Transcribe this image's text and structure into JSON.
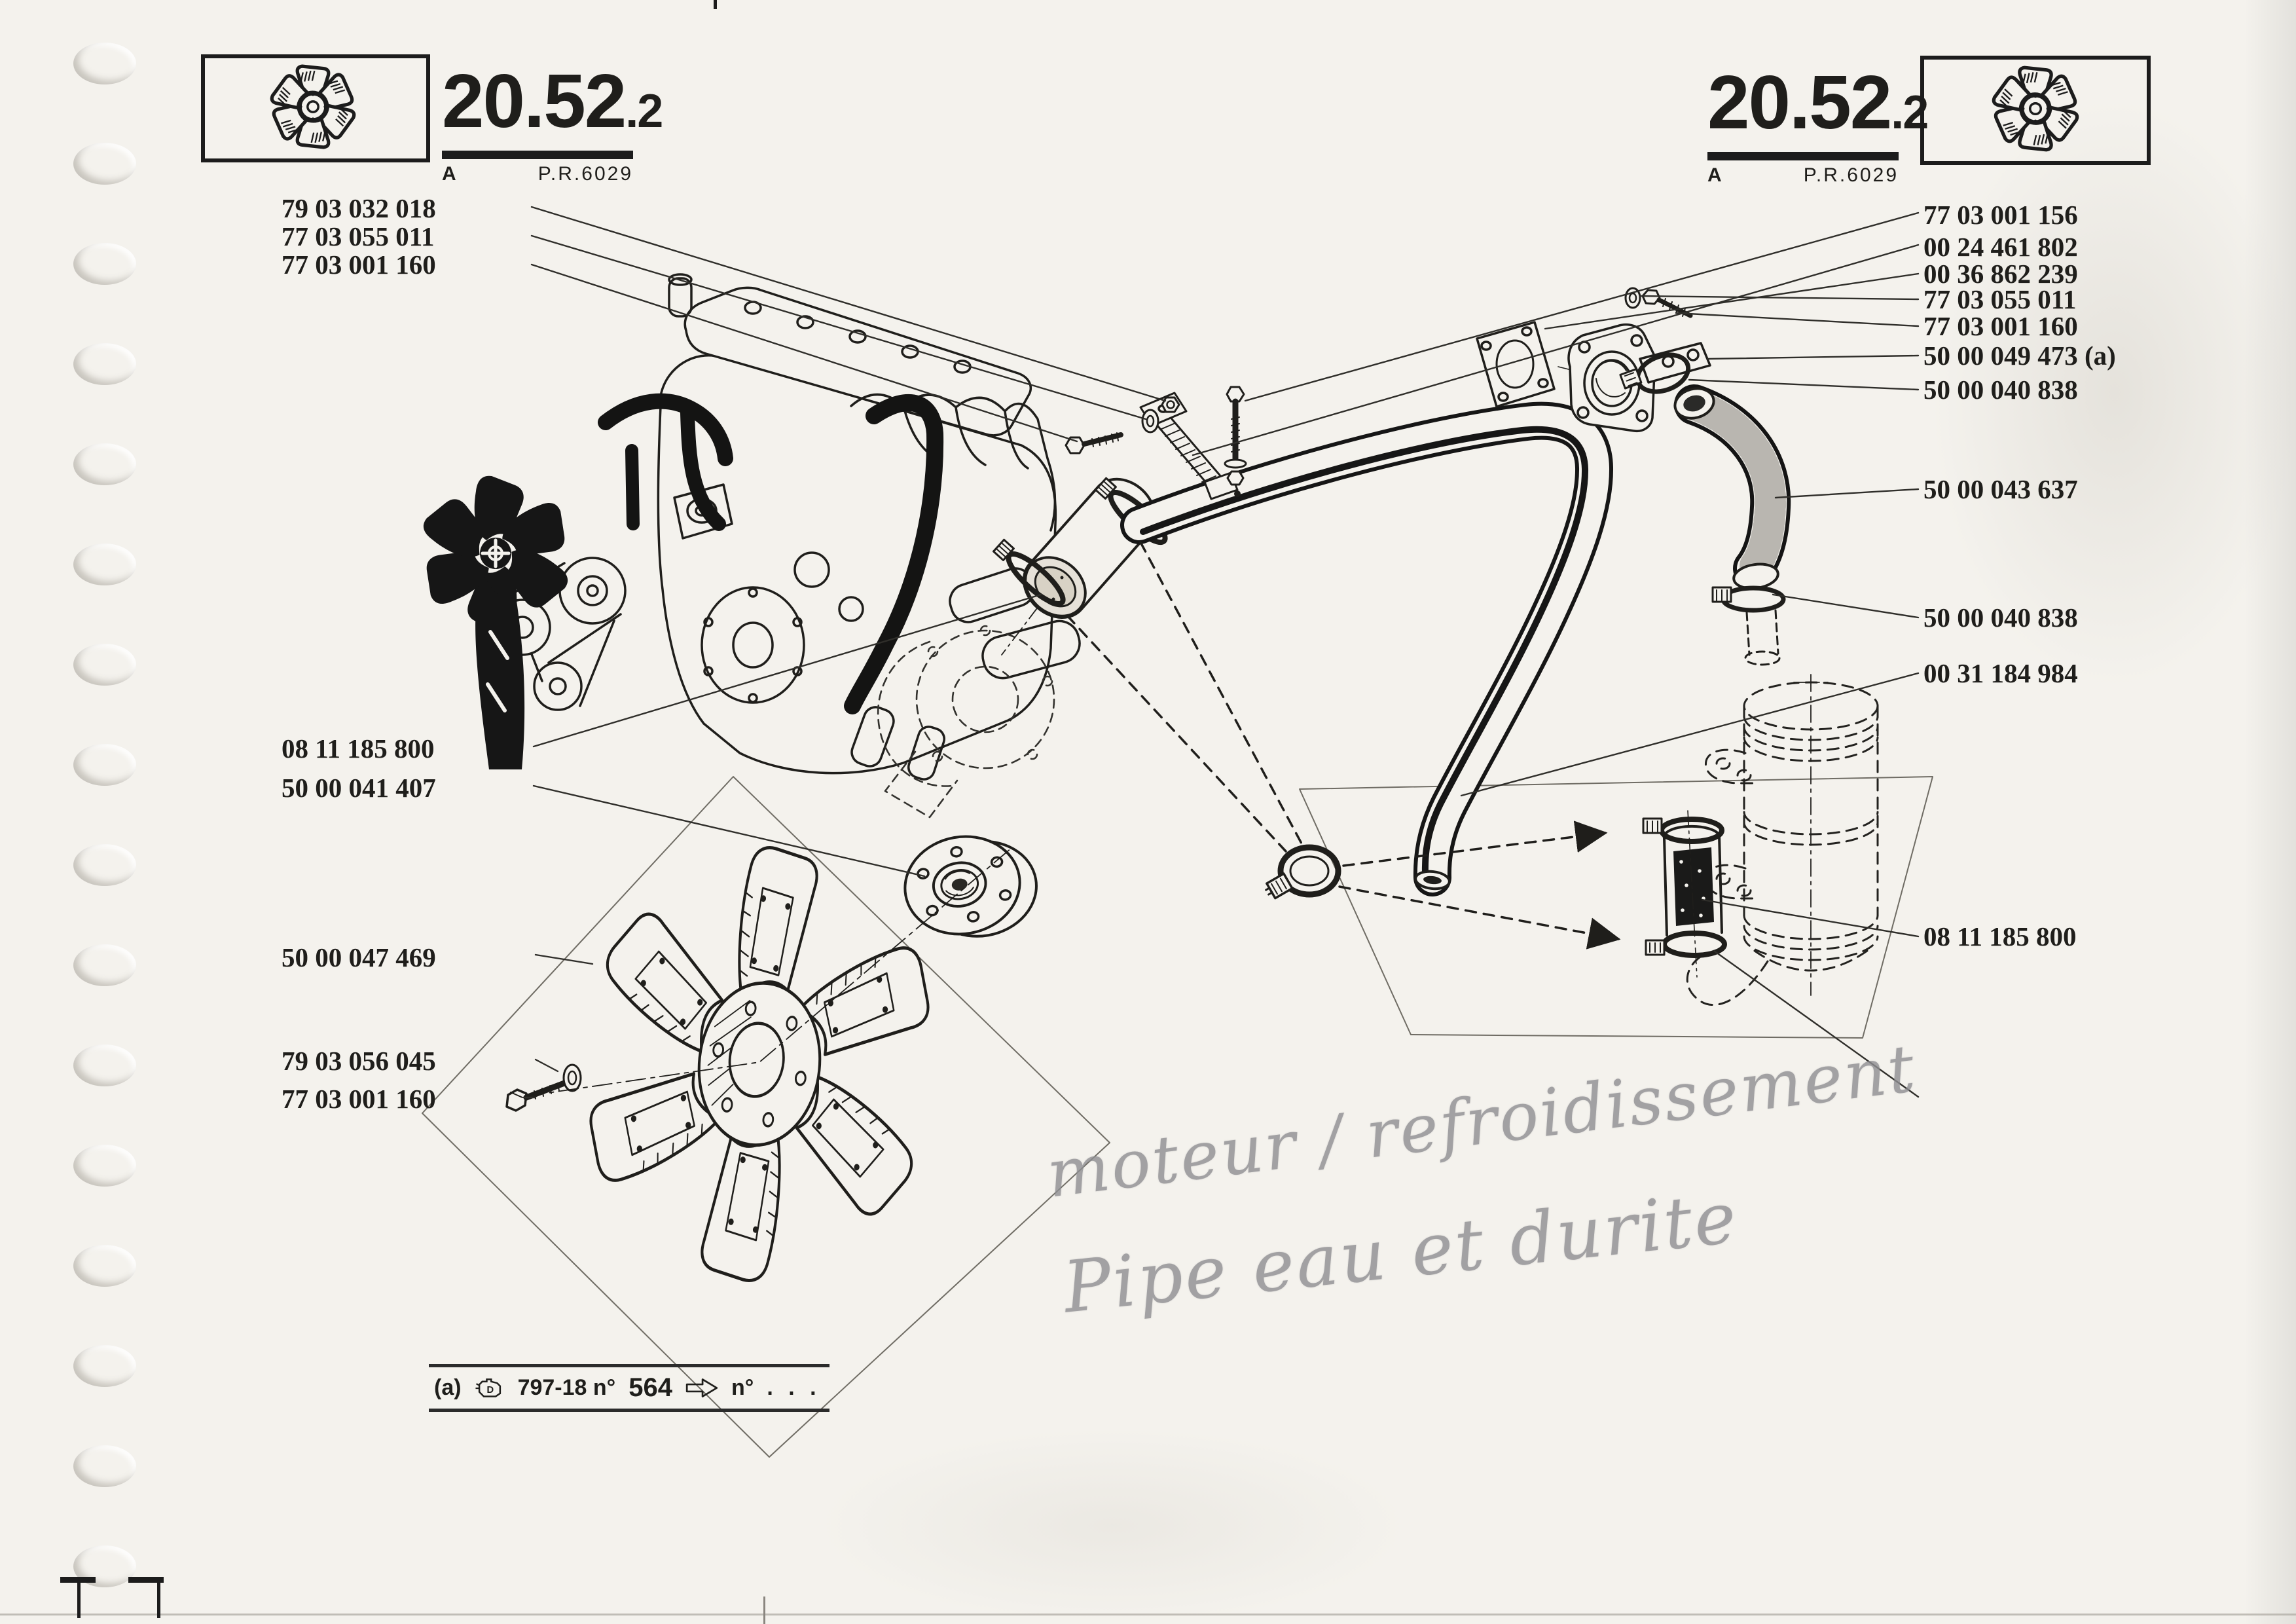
{
  "page": {
    "paper_color": "#f4f2ed",
    "ink_color": "#1f1e1b",
    "pencil_color": "#8e8e91"
  },
  "header": {
    "number_main": "20.52",
    "number_sub": ".2",
    "index_letter": "A",
    "plate_ref": "P.R.6029"
  },
  "labels_left": [
    "79 03 032 018",
    "77 03 055 011",
    "77 03 001 160",
    "08 11 185 800",
    "50 00 041 407",
    "50 00 047 469",
    "79 03 056 045",
    "77 03 001 160"
  ],
  "labels_right": [
    "77 03 001 156",
    "00 24 461 802",
    "00 36 862 239",
    "77 03 055 011",
    "77 03 001 160",
    "50 00 049 473 (a)",
    "50 00 040 838",
    "50 00 043 637",
    "50 00 040 838",
    "00 31 184 984",
    "08 11 185 800",
    "50 00 040 838"
  ],
  "footnote": {
    "marker": "(a)",
    "ref": "797-18 n°",
    "number": "564",
    "arrow_to": "n°",
    "dots": ". . ."
  },
  "handwriting": {
    "line1": "moteur / refroidissement",
    "line2": "Pipe eau et durite"
  },
  "icons": [
    "fan-icon",
    "engine-icon",
    "arrow-icon"
  ]
}
